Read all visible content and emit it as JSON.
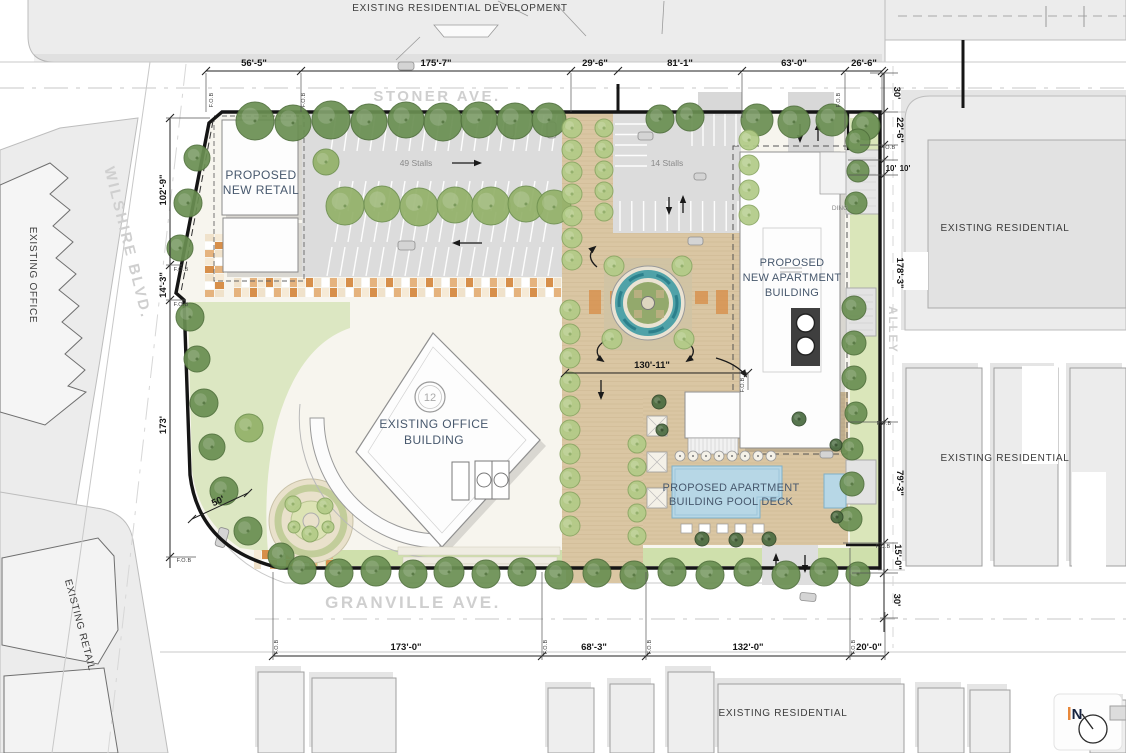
{
  "plan": {
    "streets": {
      "stoner": "STONER AVE.",
      "granville": "GRANVILLE AVE.",
      "wilshire": "WILSHIRE BLVD.",
      "alley": "ALLEY"
    },
    "context": {
      "top": "EXISTING RESIDENTIAL DEVELOPMENT",
      "left_office": "EXISTING OFFICE",
      "left_retail": "EXISTING RETAIL",
      "right_residential_top": "EXISTING RESIDENTIAL",
      "right_residential_mid": "EXISTING RESIDENTIAL",
      "bottom_residential": "EXISTING RESIDENTIAL"
    },
    "buildings": {
      "retail_line1": "PROPOSED",
      "retail_line2": "NEW RETAIL",
      "office_line1": "EXISTING OFFICE",
      "office_line2": "BUILDING",
      "office_floors": "12",
      "apartment_line1": "PROPOSED",
      "apartment_line2": "NEW APARTMENT",
      "apartment_line3": "BUILDING",
      "pool_line1": "PROPOSED APARTMENT",
      "pool_line2": "BUILDING POOL DECK",
      "loading": "DING"
    },
    "parking": {
      "main_lot": "49 Stalls",
      "small_lot": "14 Stalls"
    },
    "dimensions": {
      "top": [
        "56'-5\"",
        "175'-7\"",
        "29'-6\"",
        "81'-1\"",
        "63'-0\"",
        "26'-6\""
      ],
      "bottom": [
        "173'-0\"",
        "68'-3\"",
        "132'-0\"",
        "20'-0\""
      ],
      "left": [
        "102'-9\"",
        "14'-3\"",
        "173'",
        "50'"
      ],
      "right": [
        "30'",
        "22'-6\"",
        "10'",
        "10'",
        "178'-3\"",
        "79'-3\"",
        "15'-0\"",
        "30'"
      ],
      "center": "130'-11\"",
      "fob_marker": "F.O.B"
    },
    "north": "N",
    "colors": {
      "tree_green": "#7ca35e",
      "deck_tan": "#dac6a3",
      "water_teal": "#3f9aa3",
      "pool_blue": "#b7d7e6",
      "asphalt": "#dcdcdc",
      "paving_orange": "#d78f4a",
      "property_line": "#151515",
      "street_label_gray": "#cfcfcf"
    }
  }
}
